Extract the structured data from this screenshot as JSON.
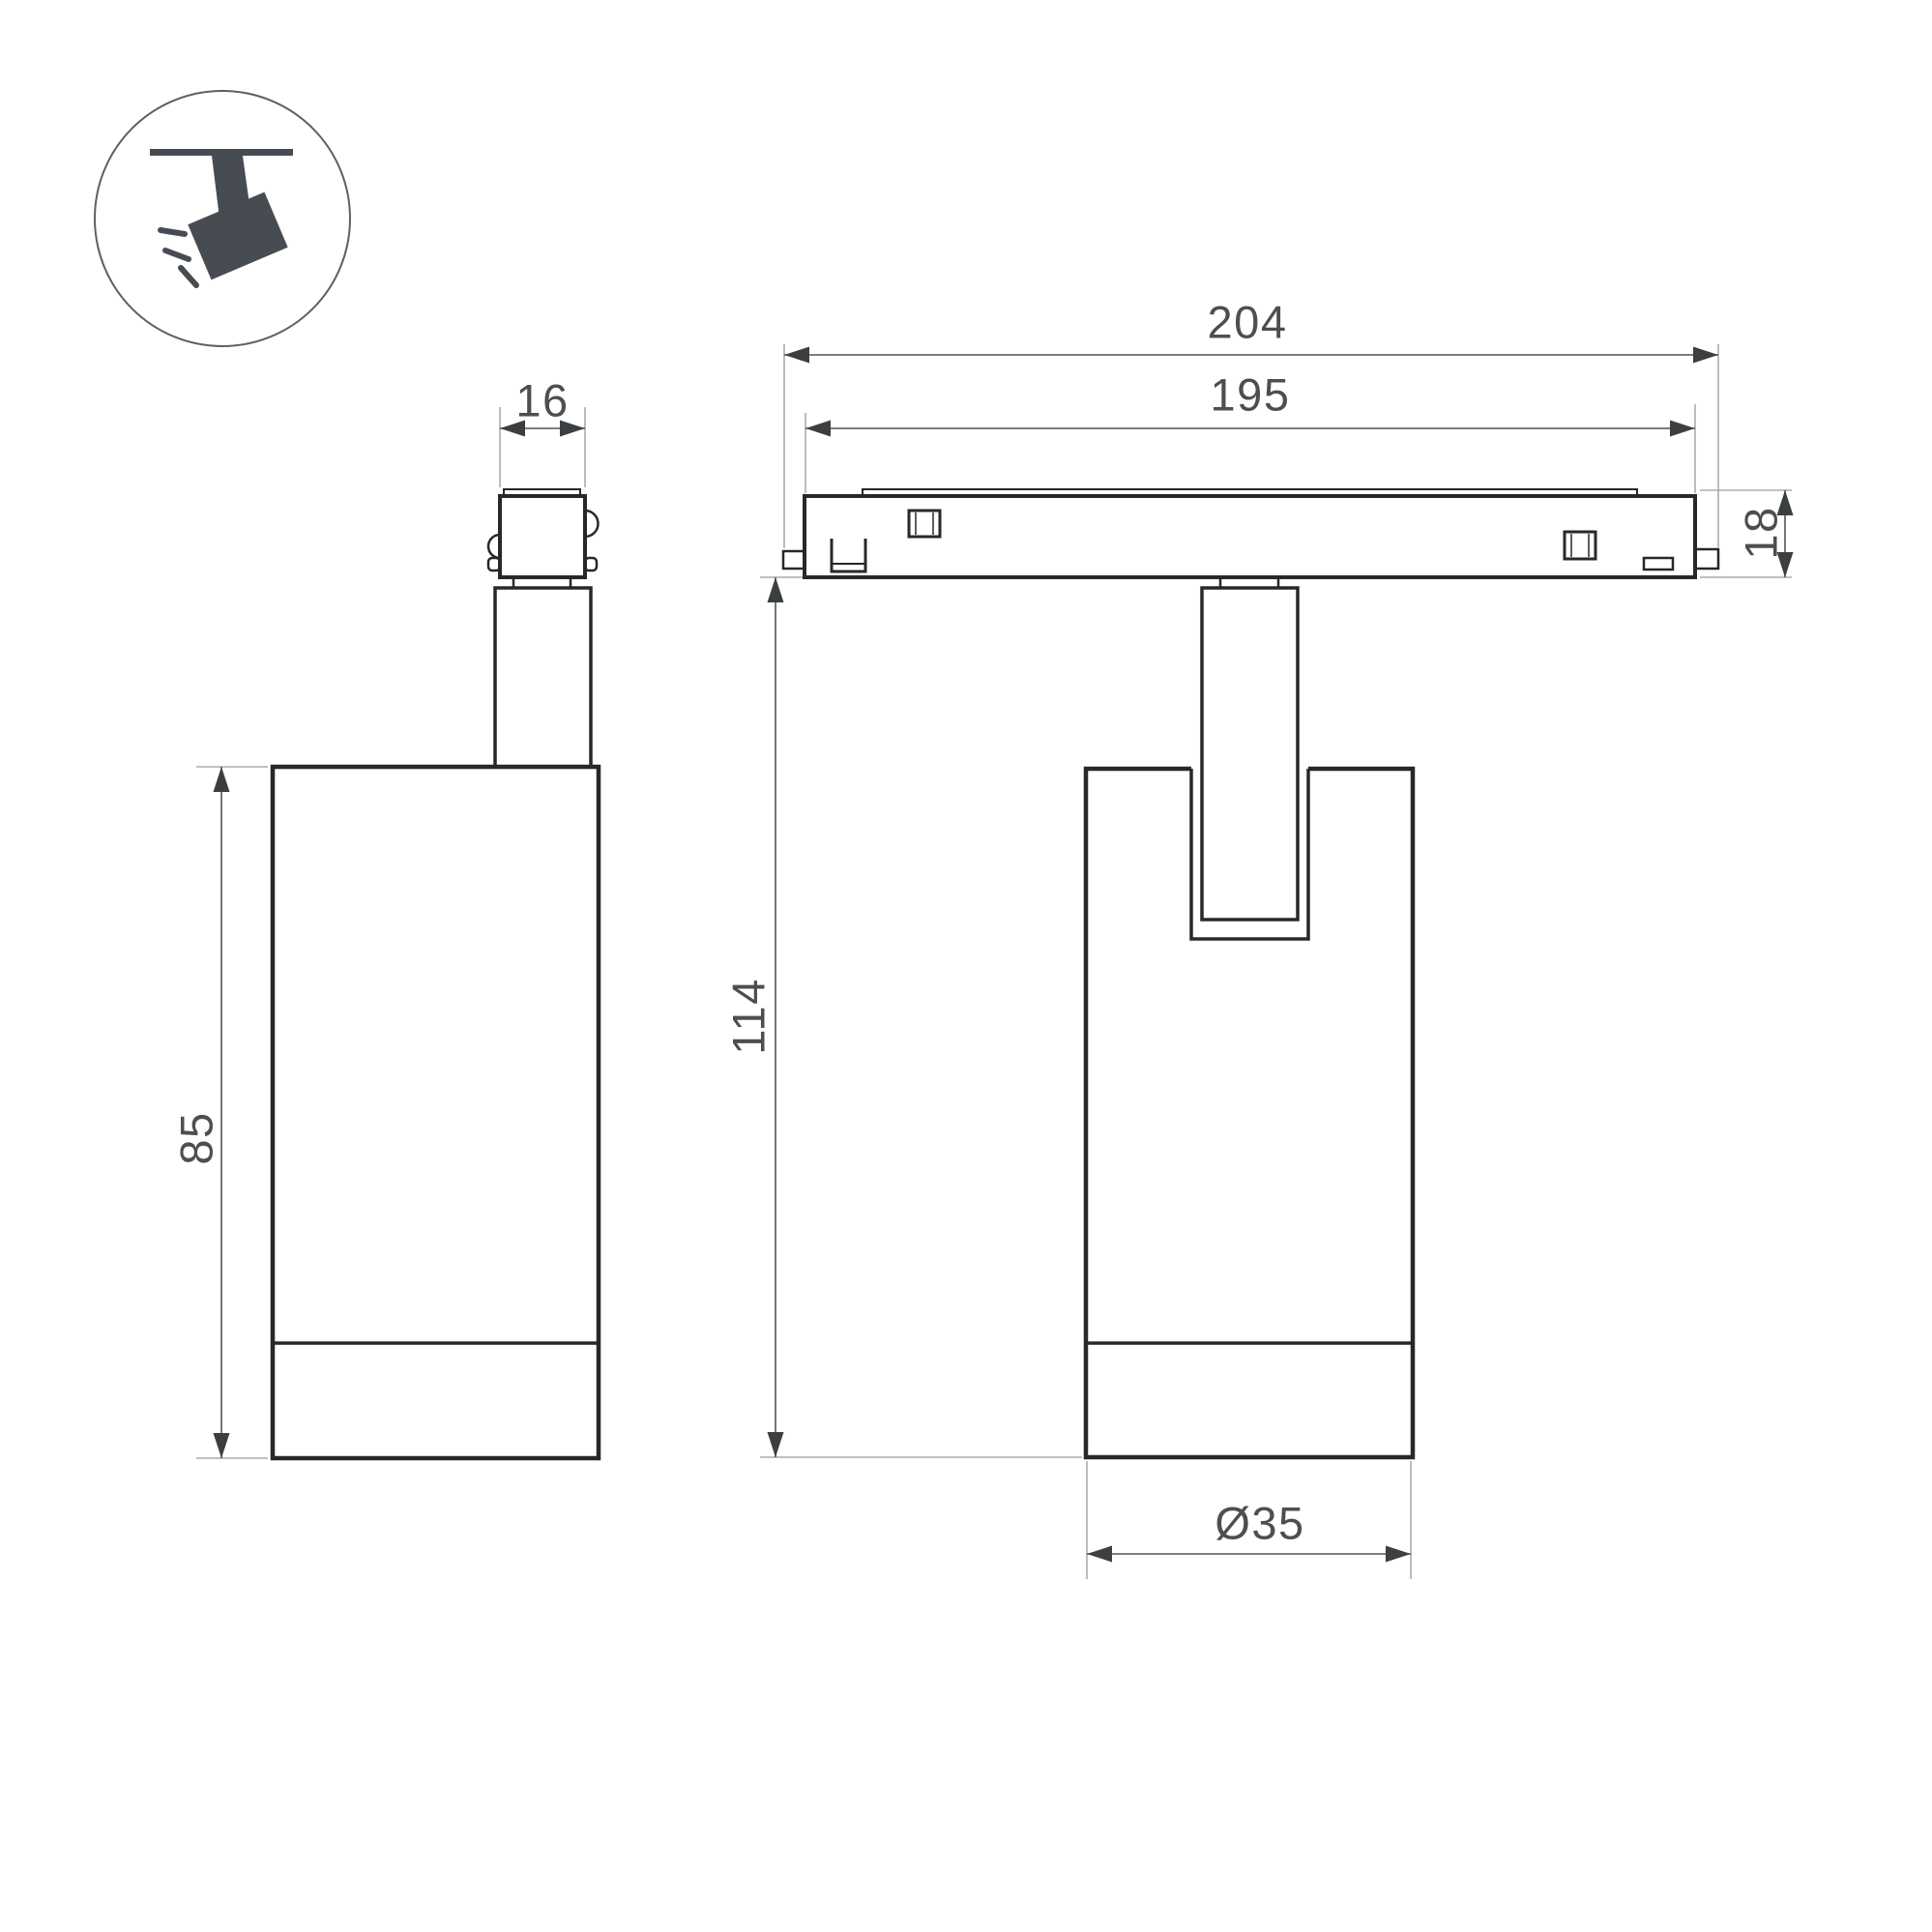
{
  "drawing": {
    "type": "technical-dimension-drawing",
    "subject": "magnetic track spotlight (side view and front view)",
    "colors": {
      "background": "#ffffff",
      "outline": "#26282a",
      "dimension_line": "#515457",
      "extension_line": "#a9abad",
      "arrow_fill": "#3c3f41",
      "text": "#4c4f52",
      "icon_fill": "#474c52",
      "icon_circle_stroke": "#5c6064"
    },
    "dimensions": {
      "adapter_width": "16",
      "body_height": "85",
      "track_overall_length": "204",
      "track_body_length": "195",
      "track_thickness": "18",
      "drop_height": "114",
      "body_diameter": "Ø35"
    },
    "icon": {
      "name": "track-spotlight-pictogram"
    }
  }
}
